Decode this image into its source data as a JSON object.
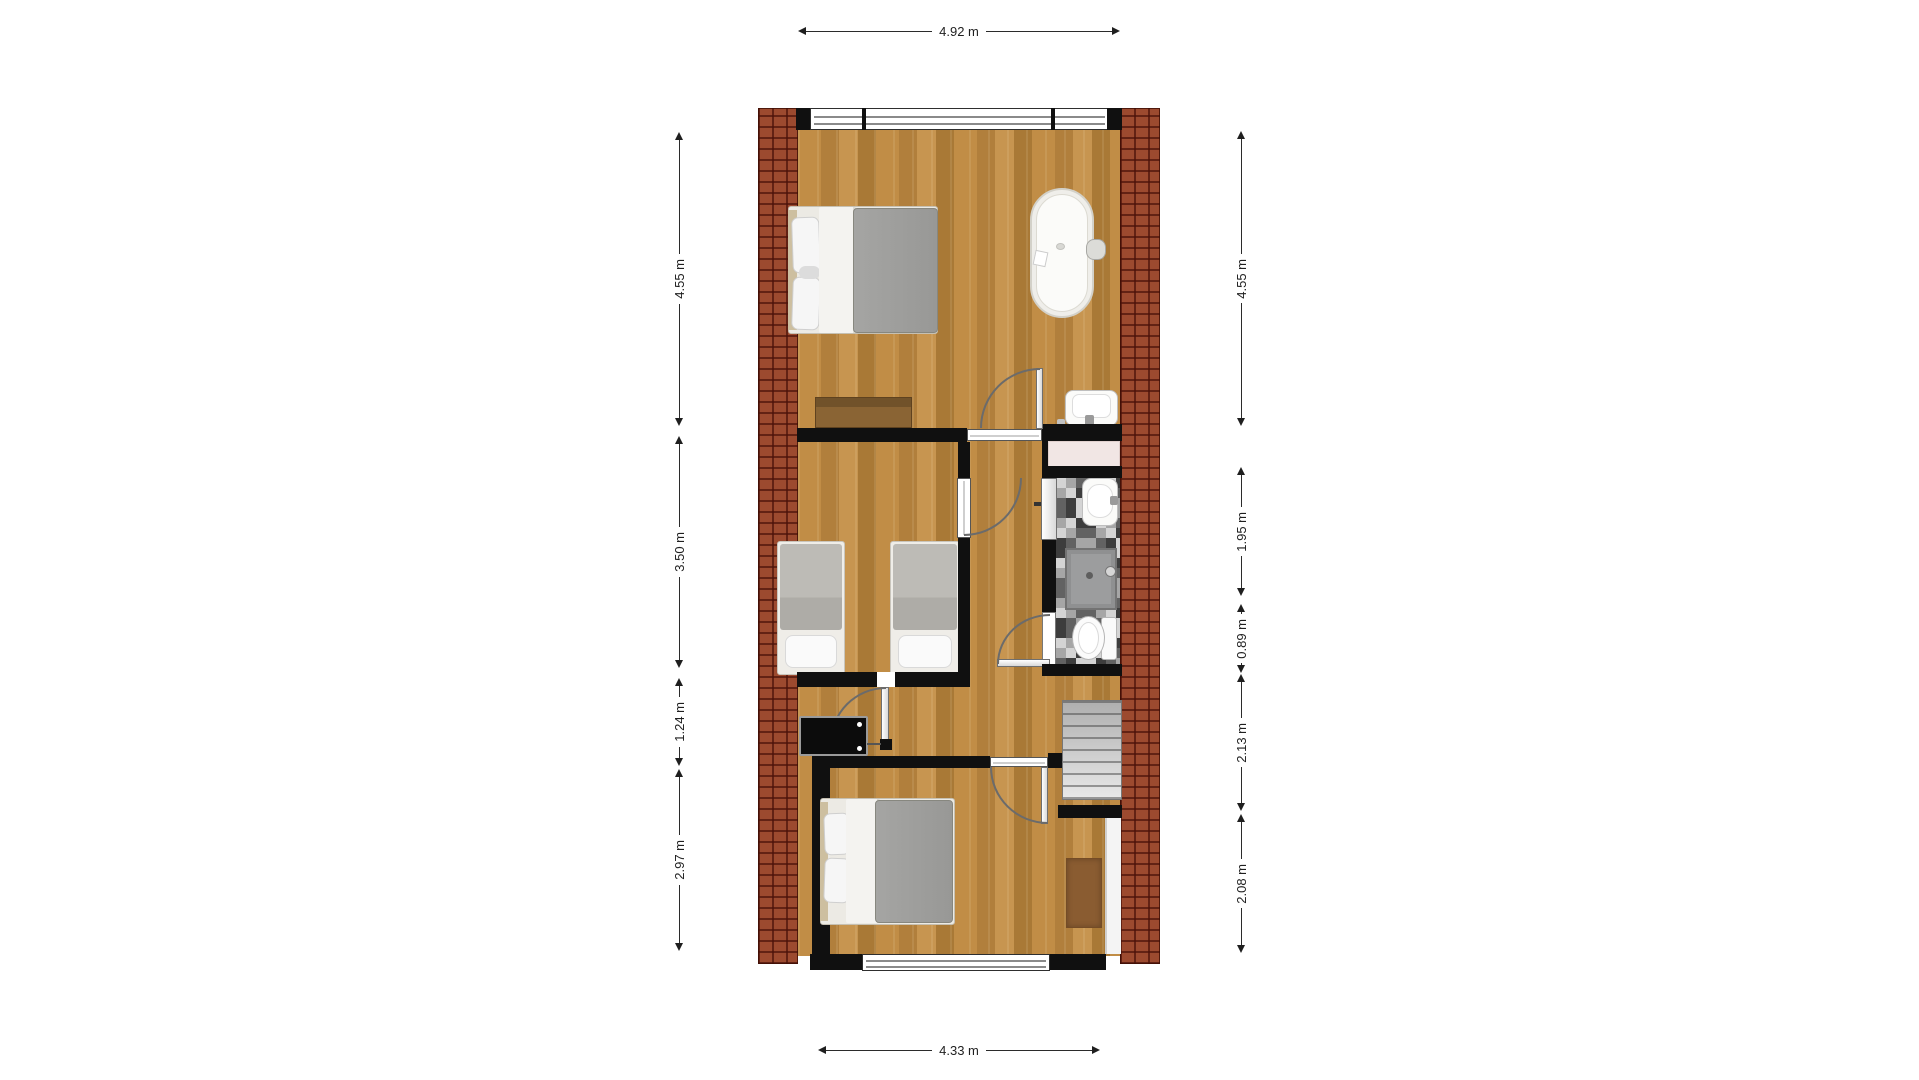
{
  "dims": {
    "top": "4.92 m",
    "bottom": "4.33 m",
    "left": [
      "4.55 m",
      "3.50 m",
      "1.24 m",
      "2.97 m"
    ],
    "right": [
      "4.55 m",
      "1.95 m",
      "0.89 m",
      "2.13 m",
      "2.08 m"
    ]
  },
  "palette": {
    "brick": "#9c4a2f",
    "brick_mortar": "#6e2a18",
    "wood_floor": "#b8873f",
    "wall": "#101010",
    "tile_dark": "#3d3d3d",
    "tile_light": "#d4d4d4",
    "duvet_gray": "#9b9b99",
    "mat_pink": "#f1e6e4",
    "stairs_gray": "#c8c8c8",
    "rug_brown": "#8a5c31"
  },
  "fixtures": [
    "double-bed",
    "double-bed",
    "single-bed",
    "single-bed",
    "bathtub",
    "washbasin",
    "washbasin",
    "shower",
    "toilet",
    "wardrobe",
    "tv",
    "staircase",
    "rug",
    "window",
    "door"
  ]
}
